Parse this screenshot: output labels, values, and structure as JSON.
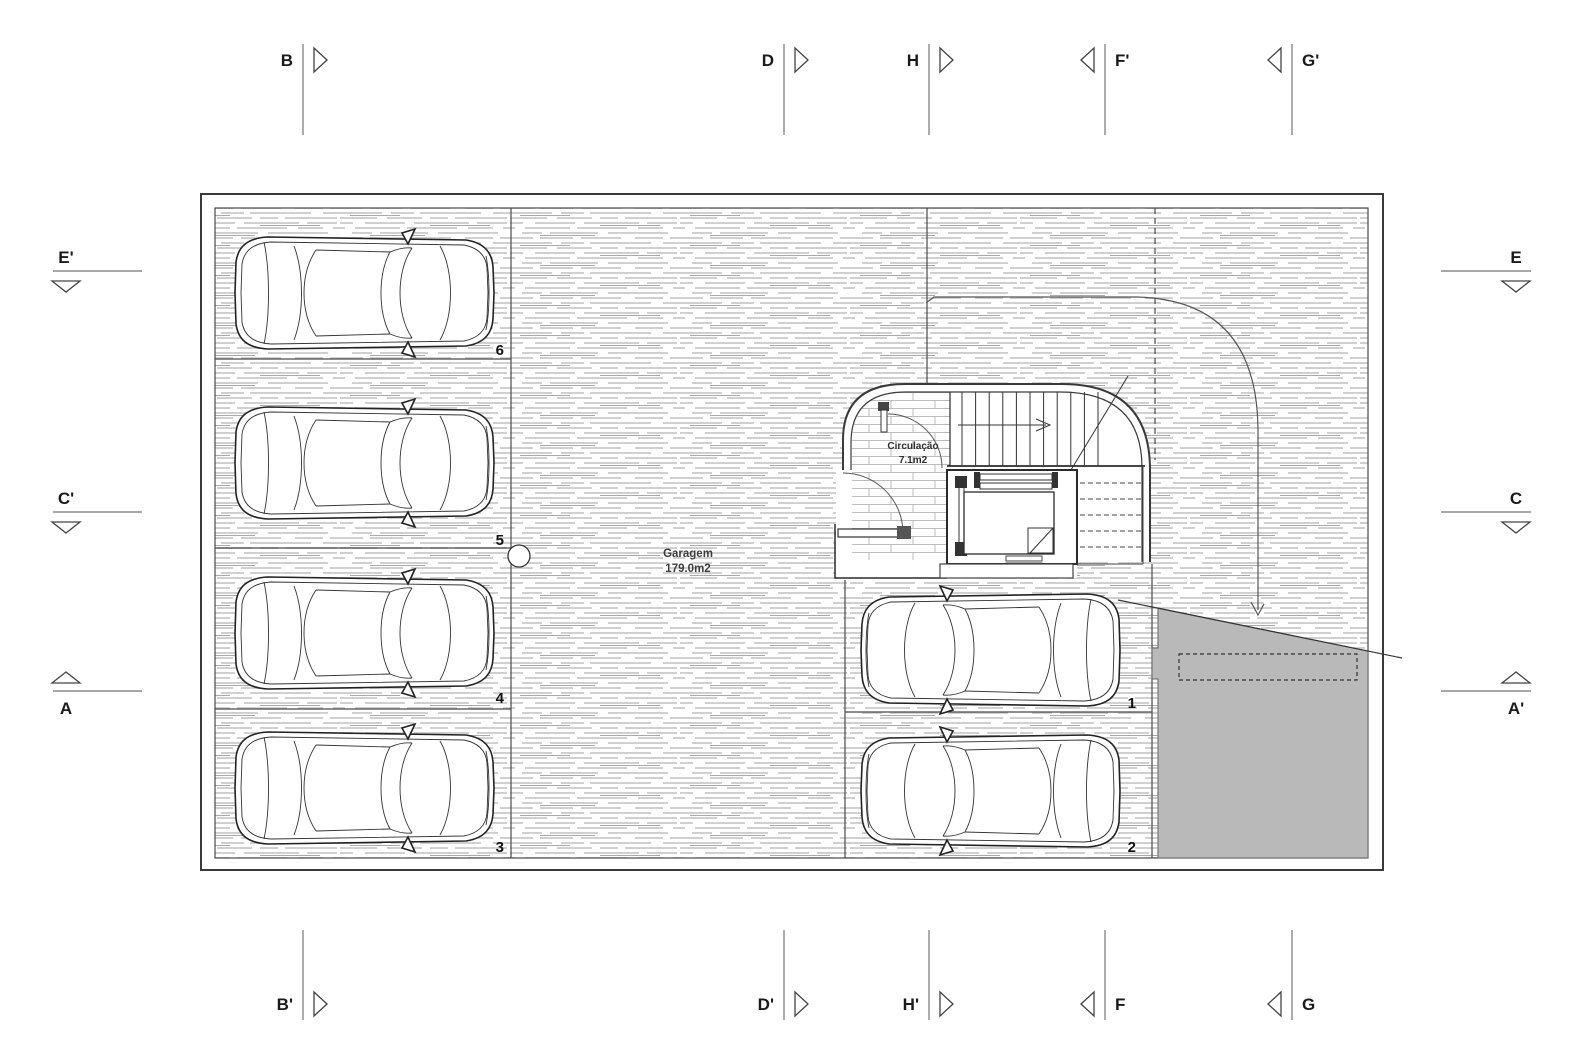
{
  "markers": {
    "top": [
      {
        "label": "B"
      },
      {
        "label": "D"
      },
      {
        "label": "H"
      },
      {
        "label": "F'"
      },
      {
        "label": "G'"
      }
    ],
    "bottom": [
      {
        "label": "B'"
      },
      {
        "label": "D'"
      },
      {
        "label": "H'"
      },
      {
        "label": "F"
      },
      {
        "label": "G"
      }
    ],
    "left": [
      {
        "label": "E'"
      },
      {
        "label": "C'"
      },
      {
        "label": "A"
      }
    ],
    "right": [
      {
        "label": "E"
      },
      {
        "label": "C"
      },
      {
        "label": "A'"
      }
    ]
  },
  "rooms": {
    "garage": {
      "name": "Garagem",
      "area": "179.0m2"
    },
    "circulation": {
      "name": "Circulação",
      "area": "7.1m2"
    }
  },
  "parking": {
    "spaces": [
      {
        "number": "1"
      },
      {
        "number": "2"
      },
      {
        "number": "3"
      },
      {
        "number": "4"
      },
      {
        "number": "5"
      },
      {
        "number": "6"
      }
    ]
  },
  "colors": {
    "text": "#1a1a1a",
    "wall": "#3a3a3a",
    "hatch_line": "#c9c9c9",
    "ramp_fill": "#b9b9b9",
    "marker_line": "#8a8a8a"
  }
}
